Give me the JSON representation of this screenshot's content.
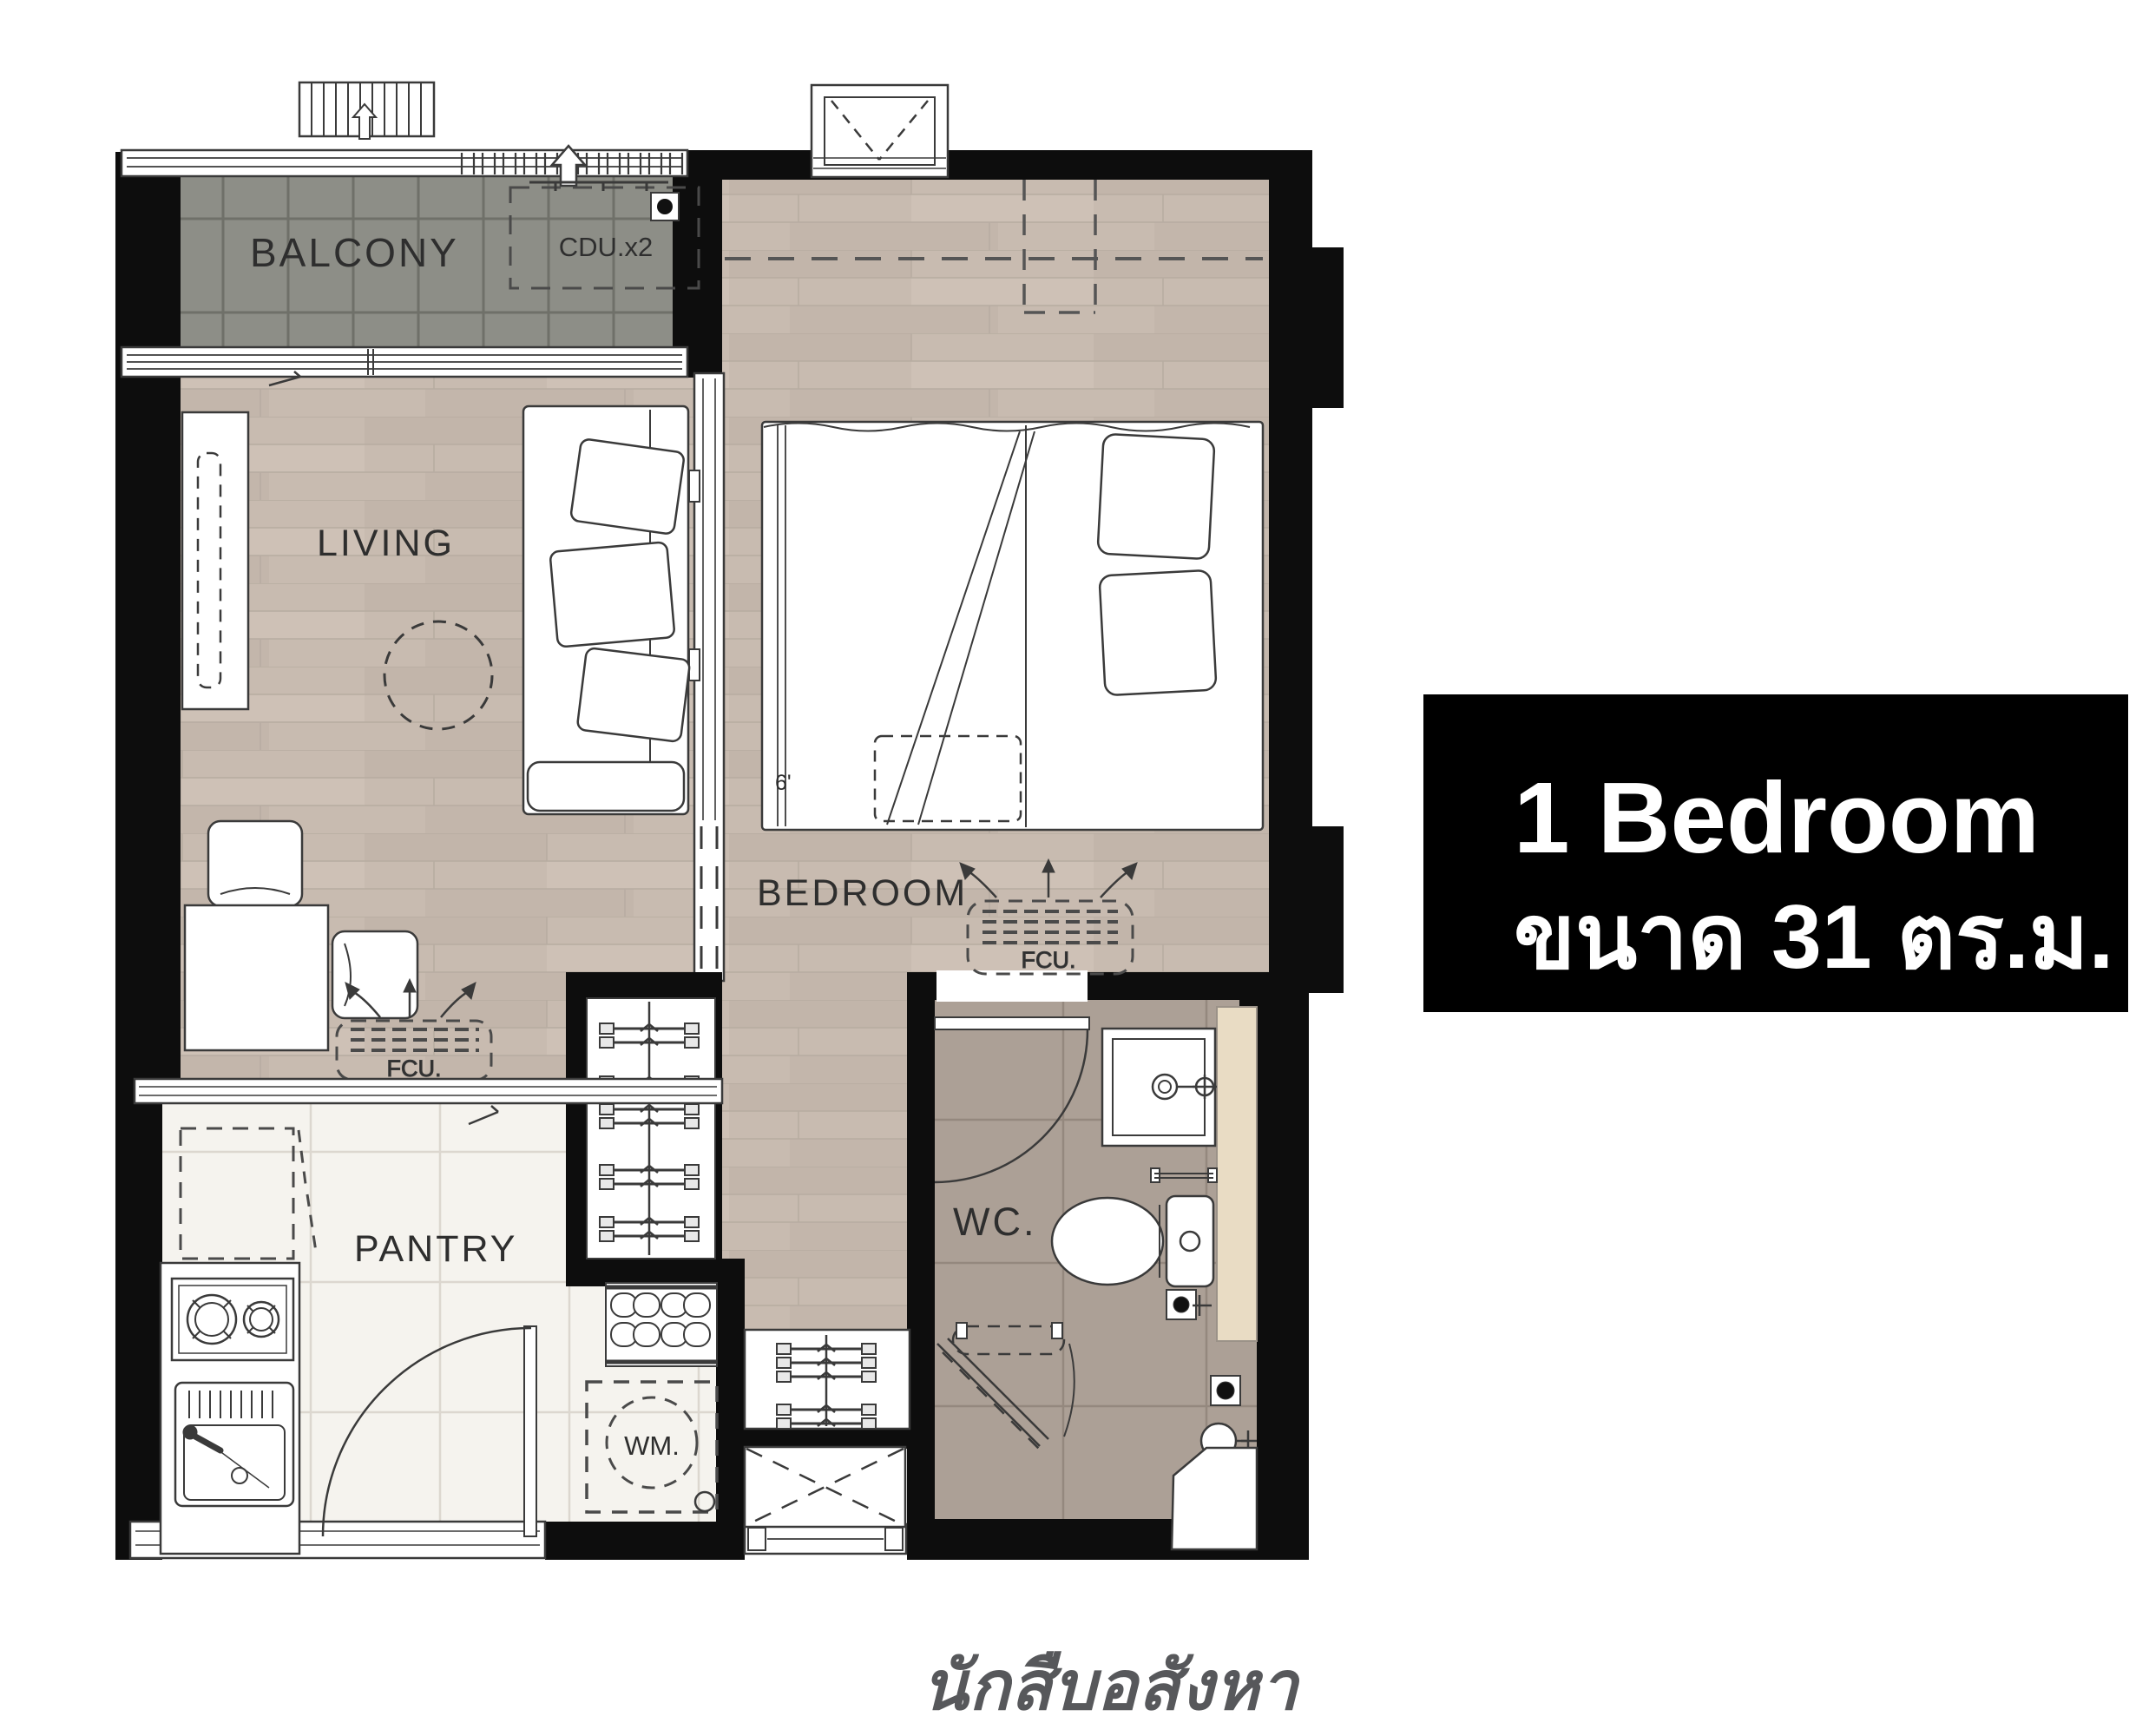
{
  "plan": {
    "labels": {
      "balcony": "BALCONY",
      "living": "LIVING",
      "bedroom": "BEDROOM",
      "pantry": "PANTRY",
      "wc": "WC.",
      "cdu": "CDU.x2",
      "fcu": "FCU.",
      "wm": "WM.",
      "bed_width": "6'"
    },
    "colors": {
      "wall": "#0d0d0d",
      "wood_floor": "#c8bbb0",
      "balcony_tile": "#8d8e87",
      "wc_tile": "#aca096",
      "pantry_floor": "#f5f3ee",
      "vanity_beige": "#e9dcc4",
      "linework": "#3a3a3a"
    }
  },
  "info_box": {
    "title": "1 Bedroom",
    "subtitle": "ขนาด 31 ตร.ม.",
    "background": "#000000",
    "text_color": "#ffffff"
  },
  "watermark": {
    "text": "นักสืบอสังหา",
    "color": "#57585b"
  }
}
